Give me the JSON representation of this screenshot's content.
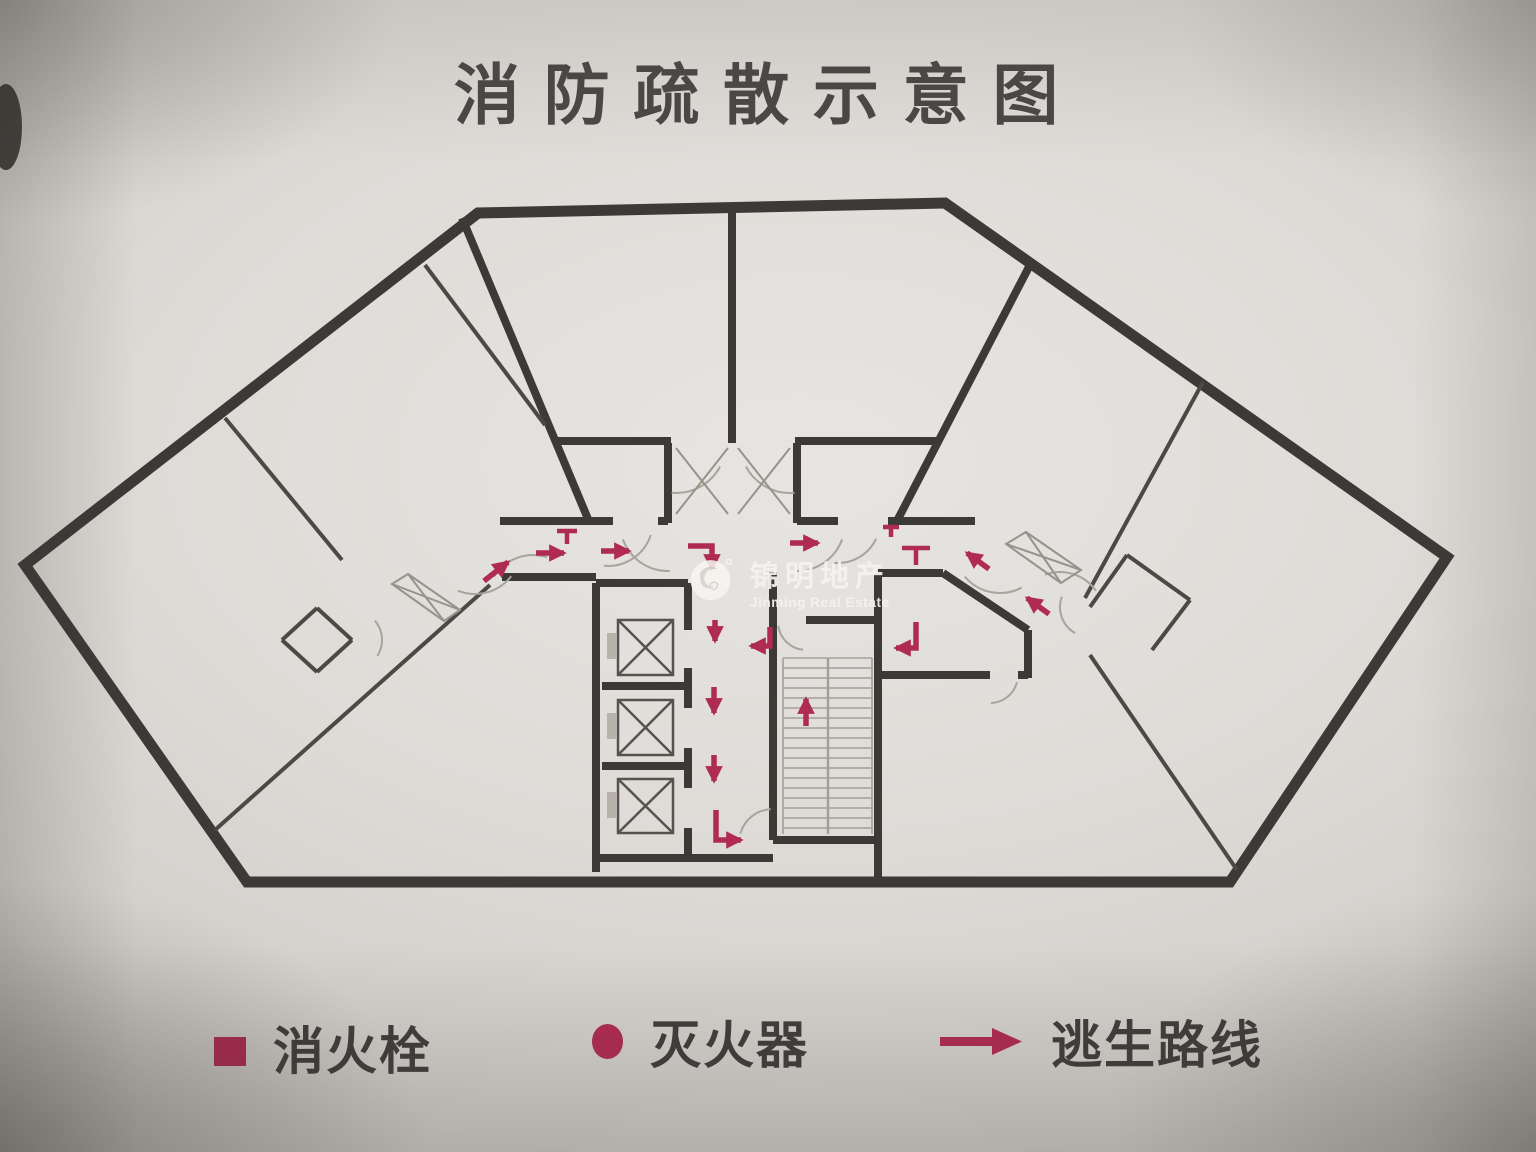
{
  "title": "消防疏散示意图",
  "watermark": {
    "name": "锦明地产",
    "subtitle": "Jinming Real Estate"
  },
  "legend": {
    "items": [
      {
        "symbol": "square",
        "label": "消火栓"
      },
      {
        "symbol": "circle",
        "label": "灭火器"
      },
      {
        "symbol": "arrow",
        "label": "逃生路线"
      }
    ]
  },
  "colors": {
    "paper": "#dedbd7",
    "wall": "#3c3a37",
    "wall_light": "#4c4945",
    "line_gray": "#97938a",
    "arc_gray": "#a8a49b",
    "tread_gray": "#a39f96",
    "accent_red": "#b02b51",
    "ink": "#4a4846",
    "ink2": "#403e3b",
    "watermark_white": "#f6f4f0"
  },
  "floorplan": {
    "outline": [
      [
        25,
        565
      ],
      [
        478,
        213
      ],
      [
        945,
        203
      ],
      [
        1447,
        557
      ],
      [
        1230,
        882
      ],
      [
        247,
        882
      ]
    ],
    "walls_heavy": [
      [
        462,
        218,
        588,
        519
      ],
      [
        1031,
        263,
        898,
        519
      ],
      [
        732,
        206,
        732,
        443
      ],
      [
        556,
        441,
        671,
        441
      ],
      [
        795,
        441,
        940,
        441
      ],
      [
        668,
        443,
        668,
        523
      ],
      [
        797,
        443,
        797,
        523
      ],
      [
        500,
        521,
        613,
        521
      ],
      [
        658,
        521,
        668,
        521
      ],
      [
        797,
        521,
        838,
        521
      ],
      [
        888,
        521,
        975,
        521
      ],
      [
        502,
        577,
        596,
        577
      ],
      [
        596,
        583,
        596,
        872
      ],
      [
        596,
        583,
        688,
        583
      ],
      [
        596,
        858,
        773,
        858
      ],
      [
        688,
        583,
        688,
        630
      ],
      [
        688,
        668,
        688,
        708
      ],
      [
        688,
        748,
        688,
        788
      ],
      [
        688,
        828,
        688,
        858
      ],
      [
        602,
        686,
        688,
        686
      ],
      [
        602,
        766,
        688,
        766
      ],
      [
        773,
        572,
        773,
        840
      ],
      [
        806,
        620,
        878,
        620
      ],
      [
        773,
        840,
        878,
        840
      ],
      [
        878,
        573,
        878,
        880
      ],
      [
        878,
        573,
        943,
        573
      ],
      [
        943,
        573,
        1028,
        630
      ],
      [
        1028,
        630,
        1028,
        678
      ],
      [
        878,
        675,
        990,
        675
      ],
      [
        1018,
        675,
        1028,
        675
      ]
    ],
    "walls_light": [
      [
        225,
        418,
        342,
        560
      ],
      [
        425,
        265,
        545,
        425
      ],
      [
        490,
        585,
        215,
        830
      ],
      [
        1203,
        382,
        1085,
        598
      ],
      [
        1090,
        655,
        1237,
        870
      ],
      [
        317,
        608,
        352,
        640
      ],
      [
        352,
        640,
        317,
        672
      ],
      [
        317,
        672,
        282,
        640
      ],
      [
        282,
        640,
        317,
        608
      ],
      [
        1127,
        555,
        1190,
        600
      ],
      [
        1190,
        600,
        1152,
        650
      ],
      [
        1090,
        607,
        1127,
        555
      ]
    ],
    "door_leaves": [
      [
        [
          392,
          584
        ],
        [
          408,
          574
        ],
        [
          460,
          610
        ],
        [
          444,
          621
        ]
      ],
      [
        [
          1006,
          544
        ],
        [
          1026,
          532
        ],
        [
          1081,
          570
        ],
        [
          1061,
          583
        ]
      ]
    ],
    "x_marks": [
      [
        676,
        448,
        728,
        514
      ],
      [
        676,
        514,
        728,
        448
      ],
      [
        738,
        448,
        790,
        514
      ],
      [
        738,
        514,
        790,
        448
      ]
    ],
    "door_arcs": [
      [
        608,
        521,
        45,
        18,
        95
      ],
      [
        668,
        523,
        48,
        88,
        160
      ],
      [
        797,
        523,
        48,
        20,
        92
      ],
      [
        676,
        443,
        50,
        28,
        95
      ],
      [
        790,
        443,
        50,
        85,
        152
      ],
      [
        838,
        521,
        42,
        25,
        95
      ],
      [
        773,
        843,
        34,
        196,
        266
      ],
      [
        990,
        675,
        28,
        15,
        88
      ],
      [
        475,
        548,
        46,
        38,
        112
      ],
      [
        533,
        601,
        46,
        212,
        288
      ],
      [
        1000,
        547,
        46,
        62,
        140
      ],
      [
        1060,
        616,
        44,
        250,
        325
      ],
      [
        352,
        640,
        30,
        -40,
        32
      ],
      [
        1090,
        607,
        30,
        120,
        200
      ],
      [
        806,
        622,
        28,
        96,
        172
      ]
    ],
    "elevators": {
      "cells": [
        [
          618,
          620,
          55,
          55
        ],
        [
          618,
          700,
          55,
          55
        ],
        [
          618,
          779,
          55,
          54
        ]
      ],
      "tabs": [
        [
          607,
          633,
          10,
          26
        ],
        [
          607,
          713,
          10,
          26
        ],
        [
          607,
          792,
          10,
          26
        ]
      ]
    },
    "stairs": {
      "x0": 783,
      "x1": 872,
      "y0": 658,
      "y1": 834,
      "step": 10,
      "mid": 828
    },
    "escape_arrows": [
      {
        "pts": [
          [
            484,
            581
          ],
          [
            508,
            562
          ]
        ]
      },
      {
        "pts": [
          [
            536,
            553
          ],
          [
            564,
            553
          ]
        ]
      },
      {
        "pts": [
          [
            601,
            551
          ],
          [
            629,
            551
          ]
        ]
      },
      {
        "pts": [
          [
            790,
            543
          ],
          [
            818,
            543
          ]
        ]
      },
      {
        "pts": [
          [
            688,
            546
          ],
          [
            712,
            546
          ],
          [
            712,
            569
          ]
        ]
      },
      {
        "pts": [
          [
            715,
            620
          ],
          [
            715,
            641
          ]
        ]
      },
      {
        "pts": [
          [
            770,
            627
          ],
          [
            770,
            646
          ],
          [
            751,
            646
          ]
        ]
      },
      {
        "pts": [
          [
            714,
            687
          ],
          [
            714,
            713
          ]
        ]
      },
      {
        "pts": [
          [
            714,
            755
          ],
          [
            714,
            781
          ]
        ]
      },
      {
        "pts": [
          [
            716,
            810
          ],
          [
            716,
            840
          ],
          [
            741,
            840
          ]
        ]
      },
      {
        "pts": [
          [
            806,
            726
          ],
          [
            806,
            699
          ]
        ]
      },
      {
        "pts": [
          [
            989,
            569
          ],
          [
            967,
            553
          ]
        ]
      },
      {
        "pts": [
          [
            1049,
            614
          ],
          [
            1027,
            598
          ]
        ]
      },
      {
        "pts": [
          [
            916,
            622
          ],
          [
            916,
            648
          ],
          [
            896,
            648
          ]
        ]
      }
    ],
    "hydrant_marks": [
      [
        567,
        531,
        20,
        13
      ],
      [
        891,
        527,
        16,
        10
      ],
      [
        916,
        548,
        28,
        17
      ]
    ]
  }
}
